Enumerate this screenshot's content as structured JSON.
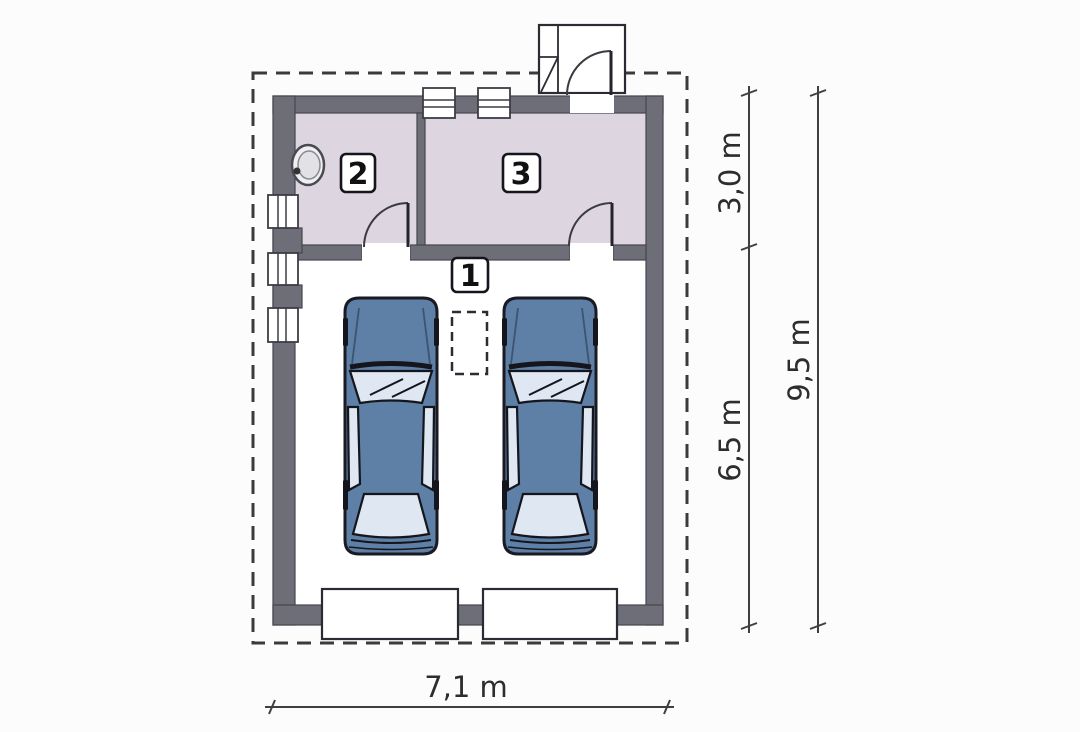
{
  "rooms": [
    {
      "number": "1"
    },
    {
      "number": "2"
    },
    {
      "number": "3"
    }
  ],
  "dimensions": {
    "upper_section_depth": "3,0 m",
    "garage_depth": "6,5 m",
    "total_depth": "9,5 m",
    "total_width": "7,1 m"
  },
  "colors": {
    "wall": "#6e6e78",
    "room-floor": "#ddd5e0",
    "garage-floor": "#ffffff",
    "car-body": "#5e80a6",
    "car-glass": "#dfe7f2",
    "outline": "#1a1a22",
    "dashed-line": "#3b3b3b",
    "dimension": "#3f3f3f"
  }
}
